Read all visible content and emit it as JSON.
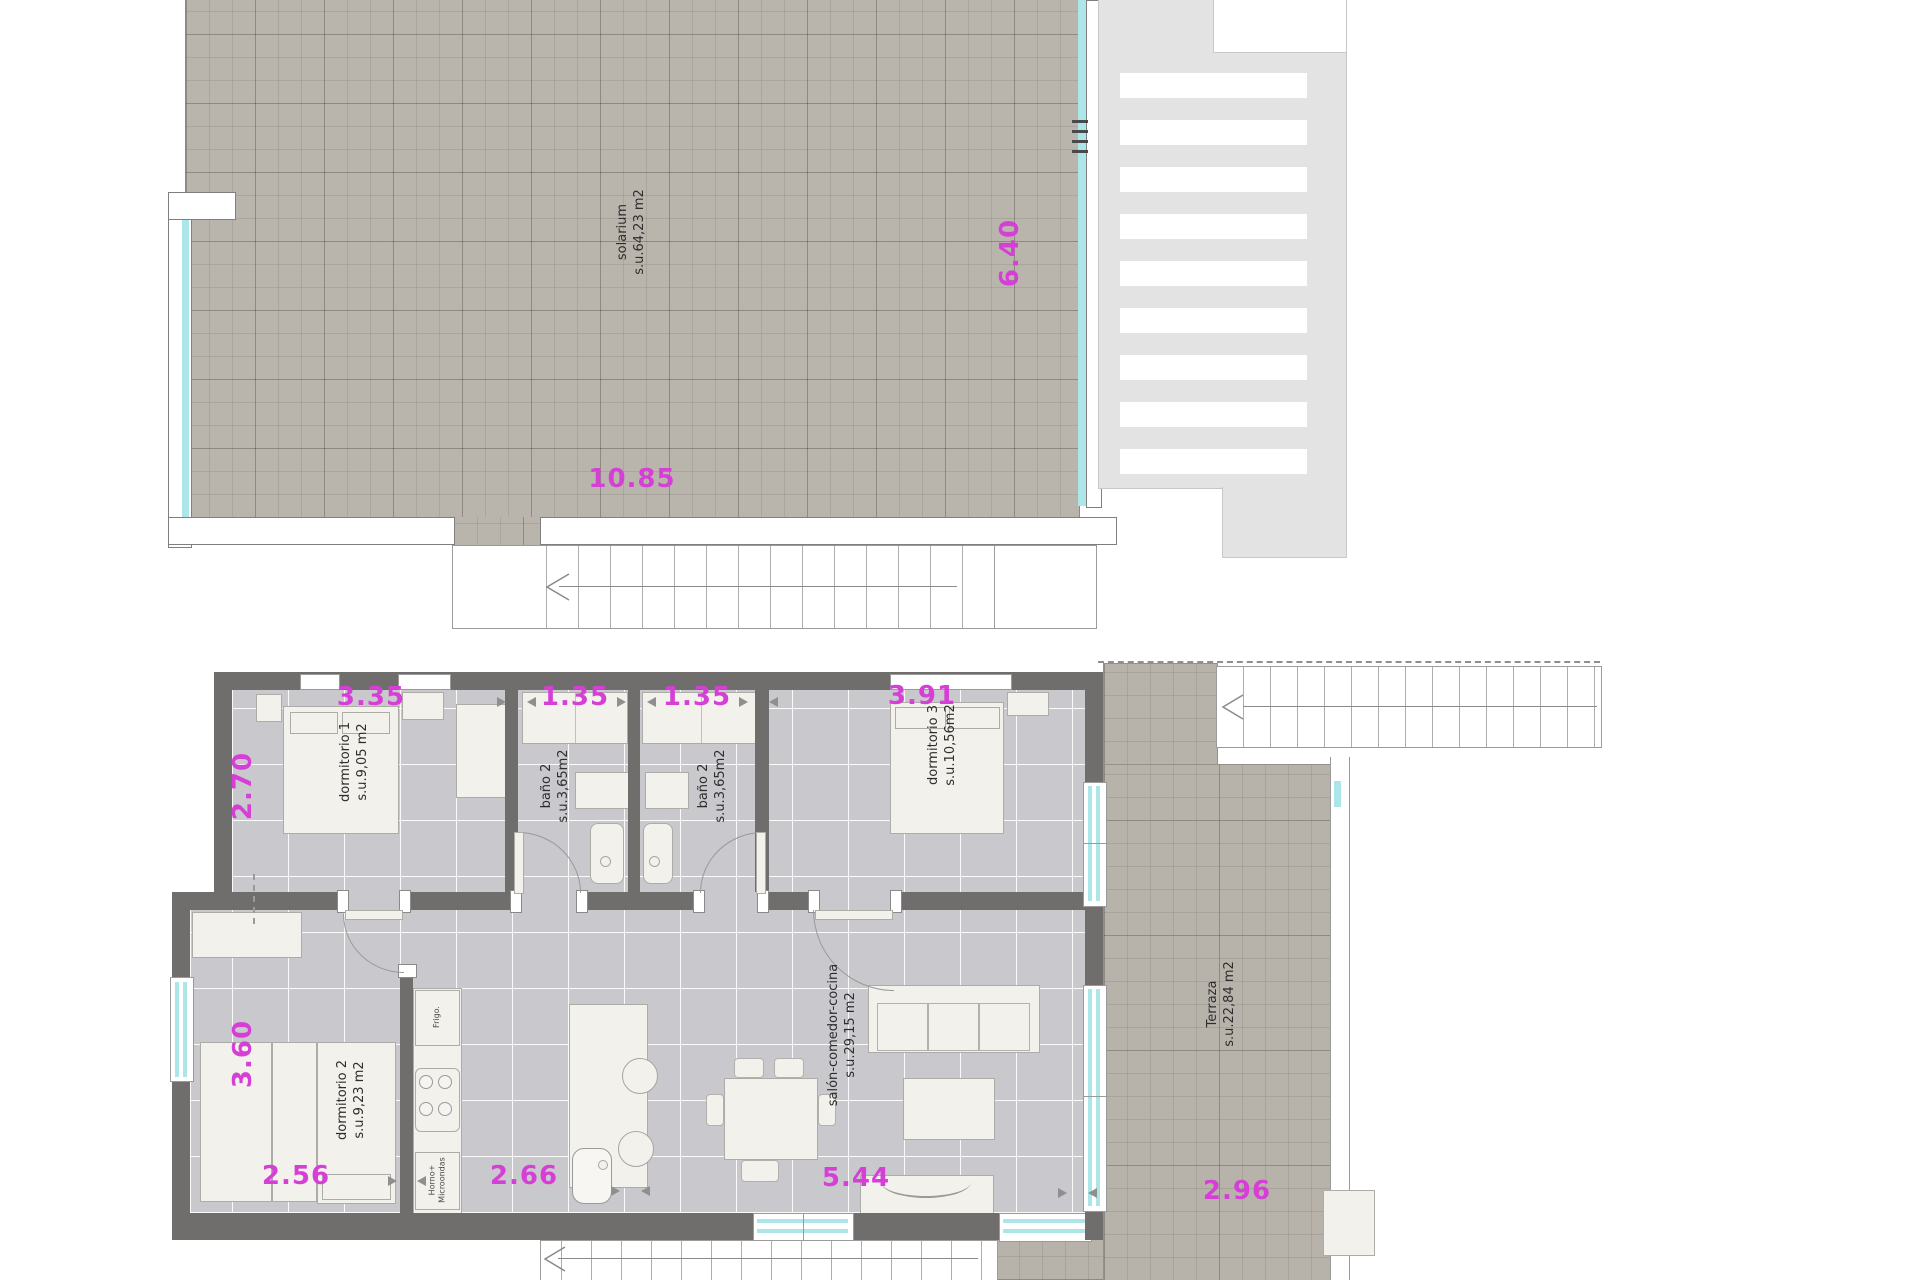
{
  "labels": {
    "solarium_name": "solarium",
    "solarium_area": "s.u.64,23 m2",
    "dorm1_name": "dormitorio 1",
    "dorm1_area": "s.u.9,05 m2",
    "bano1_name": "baño 2",
    "bano1_area": "s.u.3,65m2",
    "bano2_name": "baño 2",
    "bano2_area": "s.u.3,65m2",
    "dorm3_name": "dormitorio 3",
    "dorm3_area": "s.u.10,56m2",
    "dorm2_name": "dormitorio 2",
    "dorm2_area": "s.u.9,23 m2",
    "salon_name": "salón-comedor-cocina",
    "salon_area": "s.u.29,15 m2",
    "terraza_name": "Terraza",
    "terraza_area": "s.u.22,84 m2",
    "fridge": "Frigo.",
    "oven_line1": "Horno+",
    "oven_line2": "Microondas"
  },
  "dims": {
    "solarium_width": "10.85",
    "solarium_height": "6.40",
    "dorm1_width": "3.35",
    "bano1_width": "1.35",
    "bano2_width": "1.35",
    "dorm3_width": "3.91",
    "dorm1_height": "2.70",
    "dorm2_height": "3.60",
    "dorm2_width": "2.56",
    "kitchen_width": "2.66",
    "salon_width": "5.44",
    "terraza_width": "2.96"
  },
  "colors": {
    "dimension_text": "#d63fd6",
    "wall": "#6f6e6c",
    "glass": "#ade6e8",
    "solarium_tile": "#b9b5ad",
    "interior_floor": "#c8c8cd",
    "room_text": "#2d2d2d"
  }
}
